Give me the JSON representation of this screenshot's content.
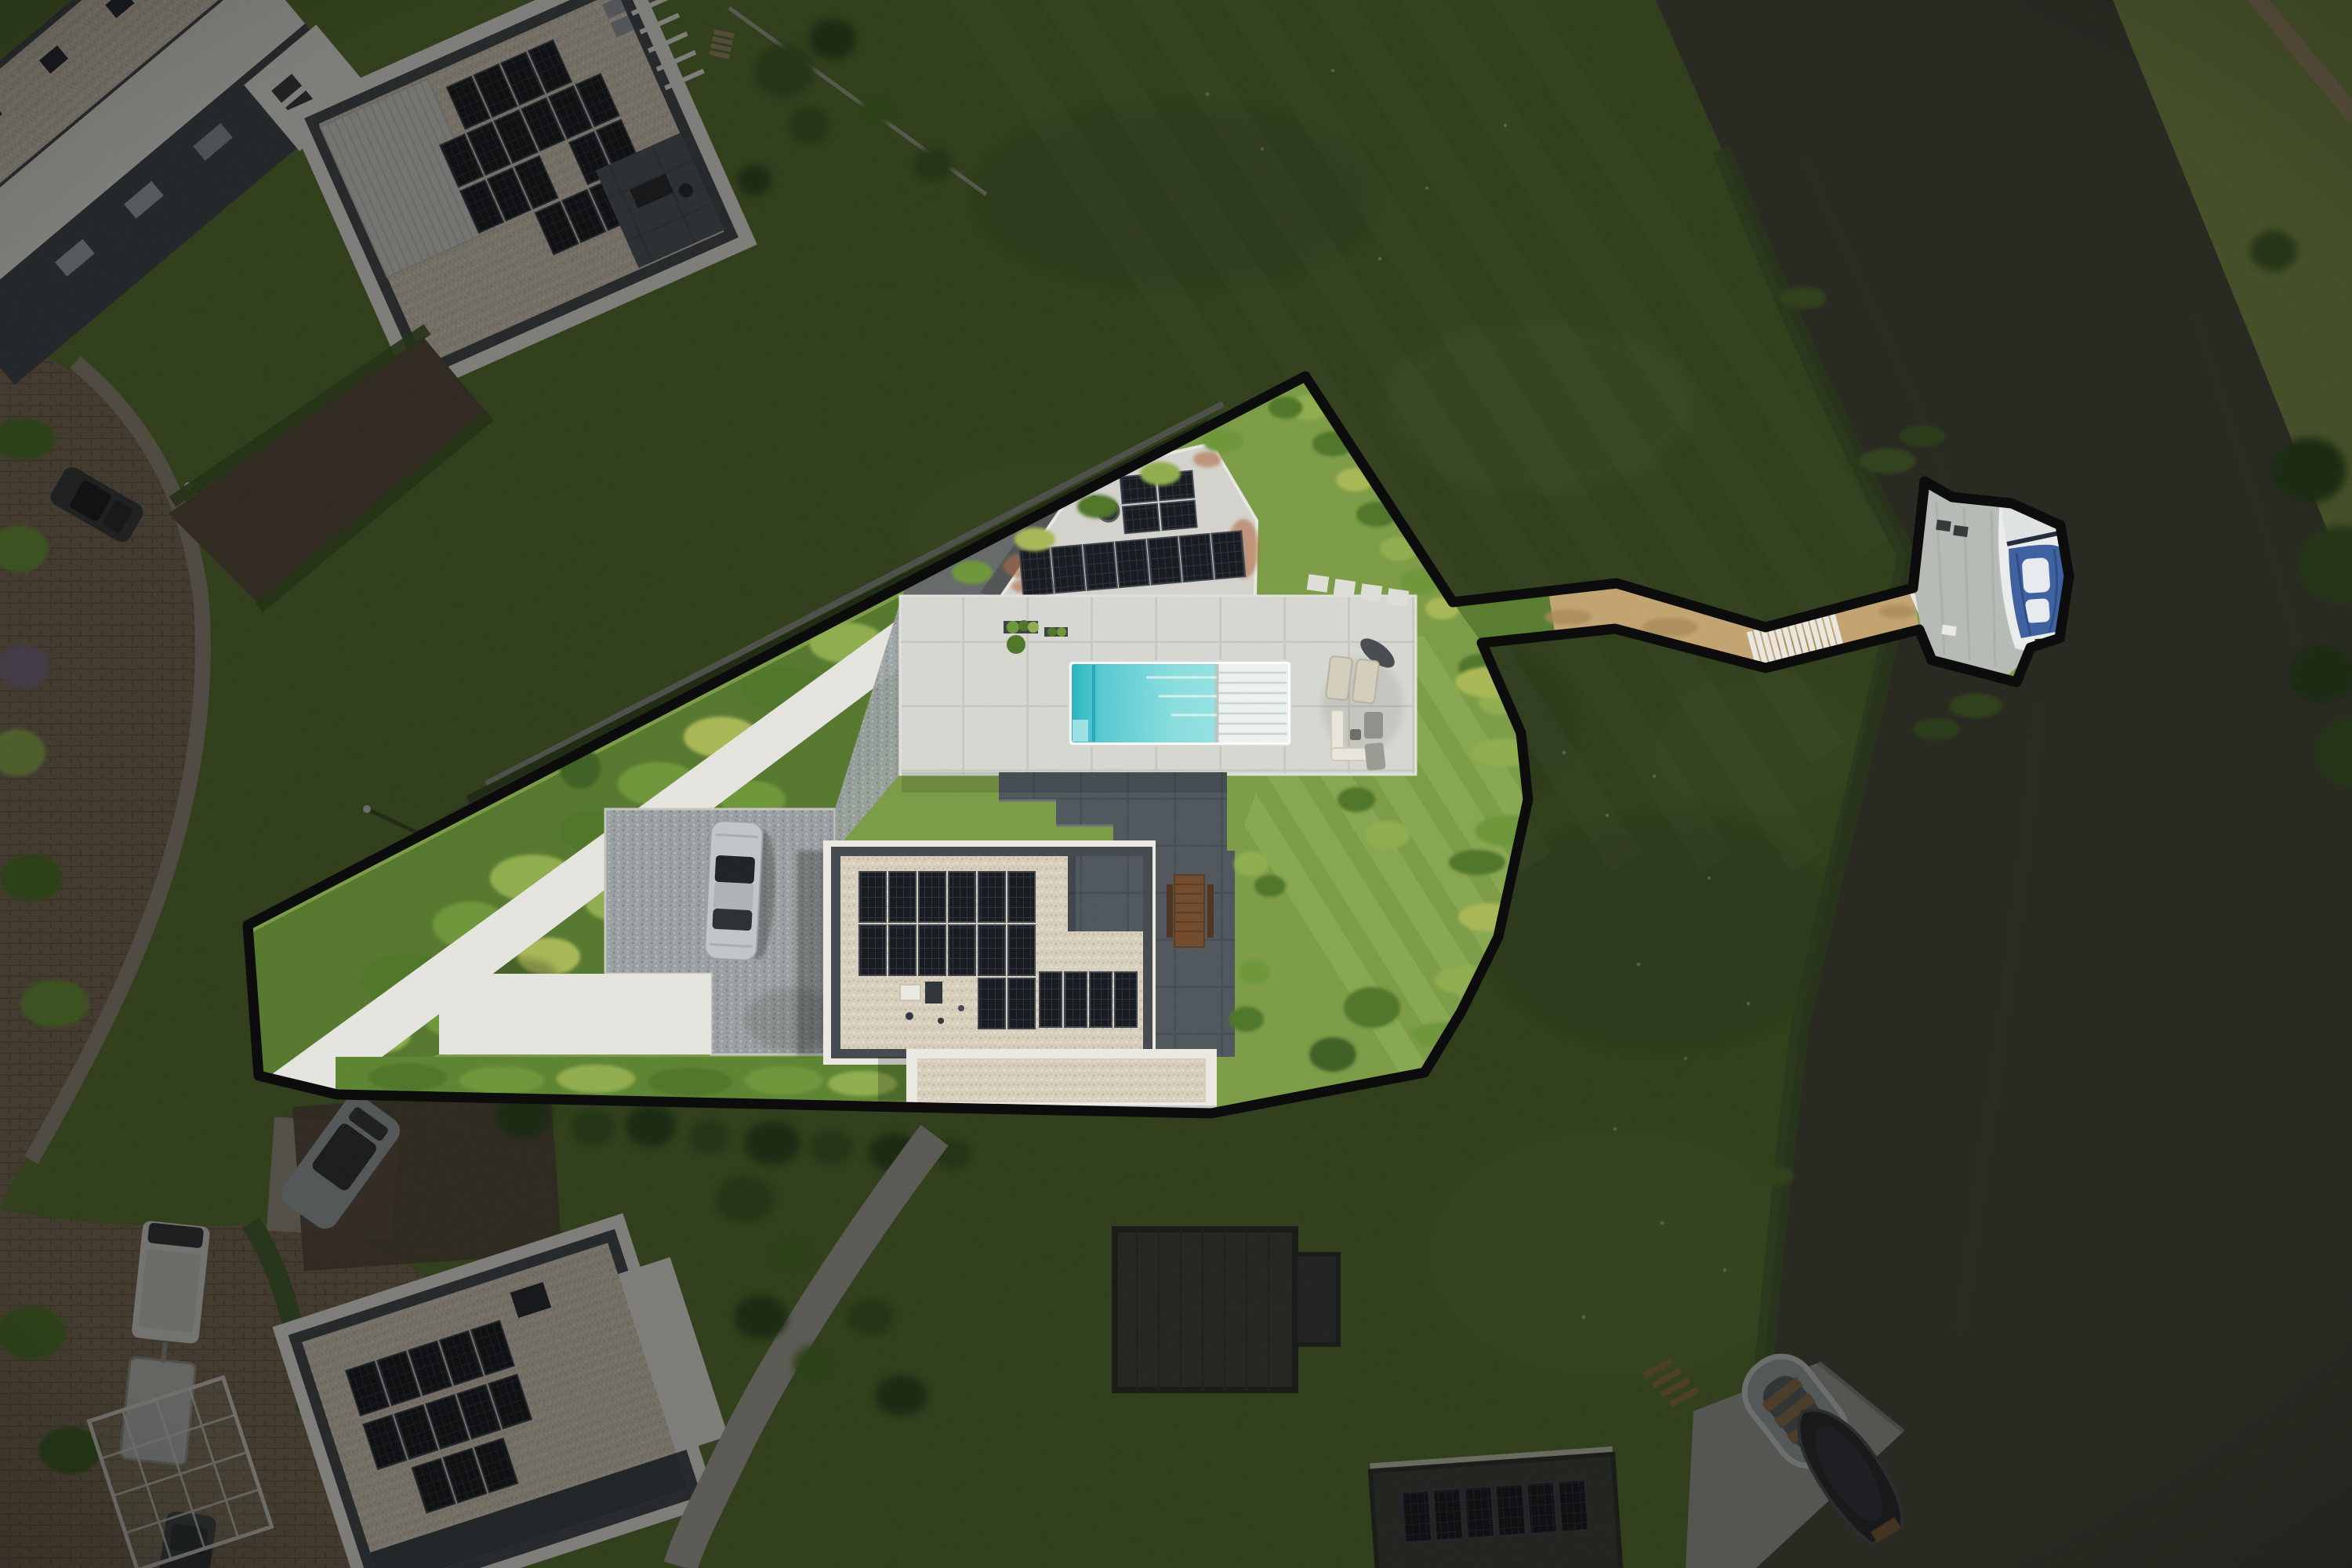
{
  "scene": {
    "type": "aerial-drone-photograph",
    "view": "top-down real-estate photo of a waterfront villa plot; plot interior shown at normal exposure, everything outside the black plot outline darkened",
    "property": {
      "boundary_outline": "thick black polygon around plot, including corridor to private jetty on the canal",
      "main_house": {
        "roof": "flat roof with light ballast gravel and dark parapet",
        "solar_panels": "18 dark panels in vertical strips plus row of 4 panels",
        "roof_terrace": "dark tiled section at north-east corner",
        "extension": "lower flat gravel roof with white border at south side"
      },
      "pool_house": {
        "roof": "white concrete flat roof with rust stains",
        "solar_panels": "long strip of 7 panels plus 2x2 block",
        "chimney": "round dark flue"
      },
      "swimming_pool": {
        "water": "turquoise, darker deep end at west side",
        "cover": "white slatted cover rolled over east third"
      },
      "pool_terrace": "large light paved deck with planters",
      "lounge_area": "two beige sun loungers, dark parasol, white corner sofa, grey chairs",
      "outdoor_dining_table": "long wooden table with benches on dark tiled patio",
      "driveway": "grey gravel with silver sports car parked",
      "white_garden_path": "pale paved path along north-west edge",
      "gardens": "dense green shrub beds, hedges and ornamental grasses",
      "lawn": "striped mowed lawn east of house",
      "walkway": "sandy footpath corridor with two white stair flights leading to jetty",
      "jetty": "concrete dock platform",
      "boat": "white motorboat with blue cockpit cover moored at jetty"
    },
    "surroundings": {
      "canal": "dark still water running along the right side",
      "far_bank": "lighter grass bank with footpath, overhanging trees",
      "embankment": "rough mowed grass slope between plot and water",
      "neighbor_houses": "modern flat-roof villas with gravel roofs and solar arrays (top-left, centre-top, bottom-left, bottom-centre)",
      "street": "brick paved street curving along the left with sidewalk",
      "parked_vehicles": "dark car on street, white camper van with trailer, grey sedan, dark car at bottom edge",
      "slipway": "concrete boat ramp at bottom-right with grey dinghy and dark covered sloop",
      "greenhouse_frame": "white glasshouse skeleton in bottom-left garden"
    }
  },
  "palette": {
    "grass-base": "#57722f",
    "lawn-in": "#7b9c45",
    "lawn-stripe": "#93b35a",
    "grass-dark": "#49612a",
    "grass-light": "#6d8a3e",
    "far-bank": "#7e9147",
    "water": "#46483a",
    "water-streak": "#54564a",
    "reeds": "#47602b",
    "tree": "#3d5f24",
    "tree-dark": "#2f4c1c",
    "bush-a": "#6d9638",
    "bush-b": "#4e7526",
    "bush-c": "#8fae4e",
    "bush-d": "#a9b854",
    "hedge": "#5c8430",
    "boundary": "#070707",
    "path-white": "#e6e5df",
    "pave-base": "#d7d8d2",
    "pave-line": "#c6c7c0",
    "patio-base": "#4e565c",
    "patio-line": "#444b51",
    "wall-white": "#eceae3",
    "parapet": "#43484d",
    "gravel-base": "#d8cfbc",
    "gravel-dot-dark": "#c2b7a0",
    "gravel-dot-light": "#eae3d3",
    "drive-base": "#9aa0a1",
    "drive-dot-dark": "#7e8486",
    "drive-dot-light": "#b6bcbd",
    "panel-base": "#14171c",
    "panel-line": "#2b313b",
    "panel-frame": "#3c434d",
    "rust": "#b06a43",
    "pool-deep": "#2ab5c2",
    "pool-mid": "#55cbd2",
    "pool-light": "#a9ebea",
    "pool-cover": "#eef3f1",
    "pool-cover-line": "#c9d5d2",
    "walk-tan": "#c3a471",
    "walk-dirt": "#a98a58",
    "stair-white": "#eae8e1",
    "dock-concrete": "#b7bbb5",
    "boat-hull": "#eceeec",
    "boat-cover": "#3c5f9f",
    "boat-cover-dark": "#2c4a84",
    "road-base": "#7a6a52",
    "road-line": "#63543f",
    "pavement": "#928b7c",
    "car-silver": "#c2c6c8",
    "car-gray": "#9aa0a0",
    "car-dark": "#33373a",
    "van-white": "#d6d5cf",
    "dim-overlay": "#000000",
    "dim-opacity": "0.47"
  }
}
